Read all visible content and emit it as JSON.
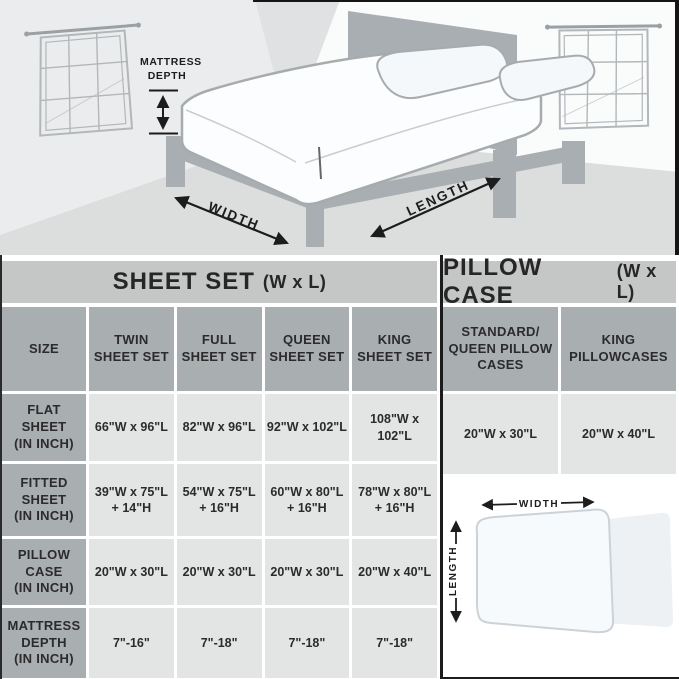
{
  "scene": {
    "mattress_depth_label": "MATTRESS\nDEPTH",
    "width_label": "WIDTH",
    "length_label": "LENGTH"
  },
  "sheet_table": {
    "title": "SHEET SET",
    "title_suffix": "(W x L)",
    "size_header": "SIZE",
    "columns": [
      "TWIN\nSHEET SET",
      "FULL\nSHEET SET",
      "QUEEN\nSHEET SET",
      "KING\nSHEET SET"
    ],
    "rows": [
      {
        "label": "FLAT\nSHEET\n(IN INCH)",
        "values": [
          "66\"W x 96\"L",
          "82\"W x 96\"L",
          "92\"W x 102\"L",
          "108\"W x 102\"L"
        ]
      },
      {
        "label": "FITTED\nSHEET\n(IN INCH)",
        "values": [
          "39\"W x 75\"L\n+ 14\"H",
          "54\"W x 75\"L\n+ 16\"H",
          "60\"W x 80\"L\n+ 16\"H",
          "78\"W x 80\"L\n+ 16\"H"
        ]
      },
      {
        "label": "PILLOW\nCASE\n(IN INCH)",
        "values": [
          "20\"W x 30\"L",
          "20\"W x 30\"L",
          "20\"W x 30\"L",
          "20\"W x 40\"L"
        ]
      },
      {
        "label": "MATTRESS\nDEPTH\n(IN INCH)",
        "values": [
          "7\"-16\"",
          "7\"-18\"",
          "7\"-18\"",
          "7\"-18\""
        ]
      }
    ]
  },
  "pillow_table": {
    "title": "PILLOW CASE",
    "title_suffix": "(W x L)",
    "columns": [
      "STANDARD/\nQUEEN PILLOW\nCASES",
      "KING\nPILLOWCASES"
    ],
    "values": [
      "20\"W x 30\"L",
      "20\"W x 40\"L"
    ]
  },
  "pillow_diagram": {
    "width_label": "WIDTH",
    "length_label": "LENGTH"
  },
  "colors": {
    "title_band": "#c5c7c6",
    "header_cell": "#a9aeb1",
    "data_cell": "#e3e4e4",
    "text": "#2b2b2b",
    "bed_frame_gray": "#a9aeb2",
    "wall_left": "#ebeced",
    "wall_right": "#fafbfb",
    "floor": "#dcdedd",
    "divider": "#1c1c1c"
  }
}
